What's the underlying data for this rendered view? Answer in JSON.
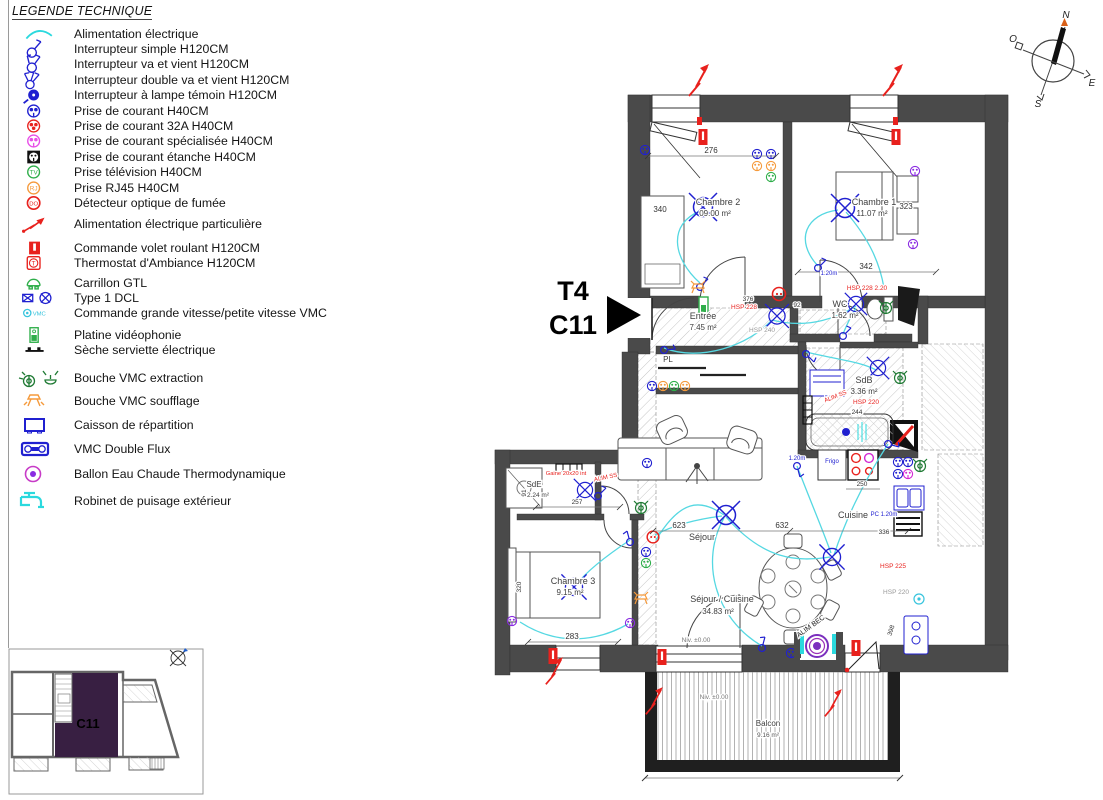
{
  "page": {
    "legend_title": "LEGENDE TECHNIQUE"
  },
  "legend": {
    "items": [
      "Alimentation électrique",
      "Interrupteur simple H120CM",
      "Interrupteur va et vient H120CM",
      "Interrupteur double va et vient H120CM",
      "Interrupteur à lampe témoin H120CM",
      "Prise de courant H40CM",
      "Prise de courant 32A H40CM",
      "Prise de courant spécialisée H40CM",
      "Prise de courant étanche H40CM",
      "Prise télévision H40CM",
      "Prise RJ45 H40CM",
      "Détecteur optique de fumée",
      "Alimentation électrique particulière",
      "Commande volet roulant H120CM",
      "Thermostat d'Ambiance H120CM",
      "Carrillon GTL",
      "Type 1 DCL",
      "Commande grande vitesse/petite vitesse VMC",
      "Platine vidéophonie",
      "Sèche serviette électrique",
      "Bouche VMC extraction",
      "Bouche VMC soufflage",
      "Caisson de répartition",
      "VMC Double Flux",
      "Ballon Eau Chaude Thermodynamique",
      "Robinet de puisage extérieur"
    ]
  },
  "unit_label": {
    "line1": "T4",
    "line2": "C11"
  },
  "compass": {
    "n": "N",
    "s": "S",
    "e": "E",
    "o": "O"
  },
  "plan": {
    "rooms": {
      "chambre2": {
        "name": "Chambre 2",
        "area": "09.00 m²"
      },
      "chambre1": {
        "name": "Chambre 1",
        "area": "11.07 m²"
      },
      "wc": {
        "name": "WC",
        "area": "1.62 m²",
        "note": "HSP 228 2.20"
      },
      "entree": {
        "name": "Entrée",
        "area": "7.45 m²",
        "note": "HSP 228"
      },
      "pl": {
        "name": "PL"
      },
      "sdb": {
        "name": "SdB",
        "area": "3.36 m²",
        "note": "HSP 220"
      },
      "cuisine": {
        "name": "Cuisine"
      },
      "sejour": {
        "name": "Séjour"
      },
      "sejour_cuisine": {
        "name": "Séjour / Cuisine",
        "area": "34.83 m²"
      },
      "sde": {
        "name": "SdE",
        "area": "2.24 m²"
      },
      "chambre3": {
        "name": "Chambre 3",
        "area": "9.15 m²"
      },
      "balcon": {
        "name": "Balcon",
        "area": "9.16 m²"
      }
    },
    "dimensions": {
      "d276": "276",
      "d340": "340",
      "d323": "323",
      "d342": "342",
      "d92": "92",
      "d376": "376",
      "d244": "244",
      "d250": "250",
      "d336": "336",
      "d623": "623",
      "d632": "632",
      "d257": "257",
      "d91": "91",
      "d283": "283",
      "d320": "320",
      "d398": "398"
    },
    "levels": {
      "sejour": "Niv. ±0.00",
      "balcon": "Niv. ±0.00"
    },
    "annotations": {
      "hsp225": "HSP 225",
      "hsp220b": "HSP 220",
      "hsp240": "HSP 240",
      "gaine": "Gaine 20x20 int",
      "alim_ss": "ALIM SS",
      "alim_ss2": "ALIM SS",
      "alim_bec": "ALIM BEC",
      "pc120": "PC 1.20m",
      "h120a": "1.20m",
      "h120b": "1.20m",
      "frigo": "Frigo"
    }
  },
  "inset": {
    "unit": "C11"
  }
}
